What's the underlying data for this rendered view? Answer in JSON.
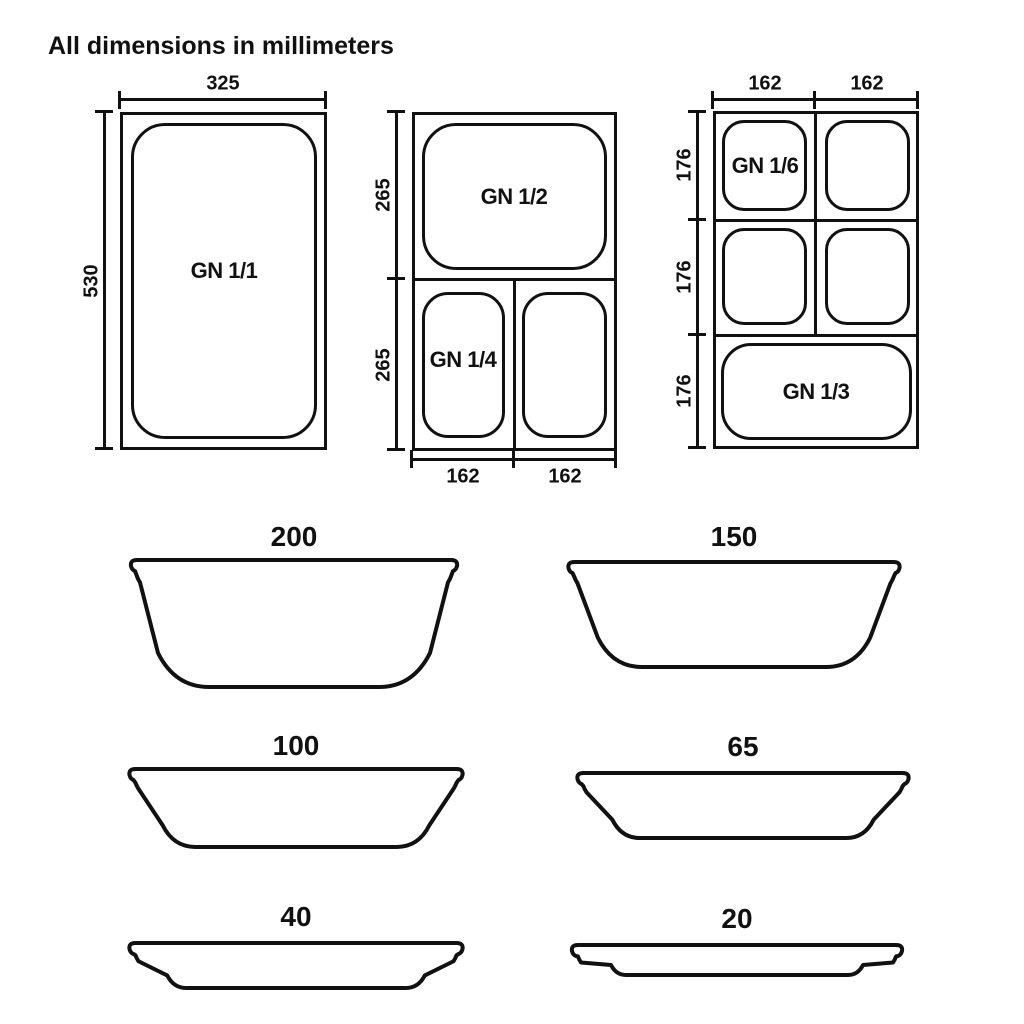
{
  "title": "All dimensions in millimeters",
  "colors": {
    "ink": "#111111",
    "background": "#ffffff"
  },
  "top_views": {
    "gn_1_1": {
      "label": "GN 1/1",
      "dim_width": "325",
      "dim_height": "530"
    },
    "gn_1_2_combo": {
      "label_top": "GN 1/2",
      "label_bottom_left": "GN 1/4",
      "dim_heights": [
        "265",
        "265"
      ],
      "dim_widths": [
        "162",
        "162"
      ]
    },
    "gn_1_6_combo": {
      "label_top_left": "GN 1/6",
      "label_bottom": "GN 1/3",
      "dim_widths": [
        "162",
        "162"
      ],
      "dim_heights": [
        "176",
        "176",
        "176"
      ]
    }
  },
  "side_profiles": [
    {
      "depth_label": "200"
    },
    {
      "depth_label": "150"
    },
    {
      "depth_label": "100"
    },
    {
      "depth_label": "65"
    },
    {
      "depth_label": "40"
    },
    {
      "depth_label": "20"
    }
  ]
}
